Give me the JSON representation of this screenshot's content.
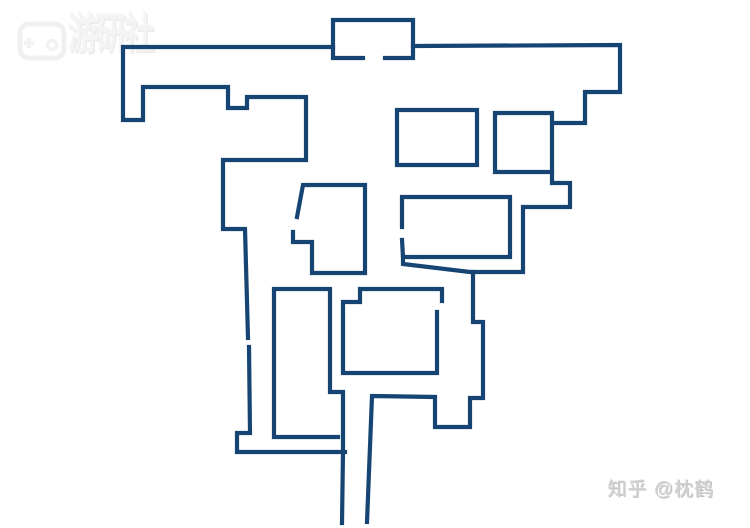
{
  "watermarks": {
    "logo": {
      "icon": "gamepad-icon",
      "brand_text": "游研社"
    },
    "credit": {
      "text": "知乎 @枕鹤"
    }
  },
  "map": {
    "background": "#ffffff",
    "stroke_color": "#164573",
    "stroke_width": 4.2,
    "width": 750,
    "height": 528,
    "polylines": [
      {
        "name": "top-center-room",
        "points": [
          [
            363,
            58
          ],
          [
            333,
            58
          ],
          [
            333,
            20
          ],
          [
            413,
            20
          ],
          [
            413,
            58
          ],
          [
            385,
            58
          ]
        ]
      },
      {
        "name": "top-left-wing-boundary",
        "points": [
          [
            333,
            47
          ],
          [
            123,
            47
          ],
          [
            123,
            120
          ],
          [
            143,
            120
          ],
          [
            143,
            87
          ],
          [
            228,
            87
          ],
          [
            228,
            108
          ],
          [
            247,
            108
          ],
          [
            247,
            97
          ],
          [
            306,
            97
          ],
          [
            306,
            160
          ],
          [
            223,
            160
          ],
          [
            223,
            229
          ],
          [
            245,
            229
          ],
          [
            248,
            338
          ]
        ]
      },
      {
        "name": "left-lower-boundary",
        "points": [
          [
            249,
            347
          ],
          [
            250,
            433
          ],
          [
            237,
            433
          ],
          [
            237,
            452
          ],
          [
            345,
            452
          ]
        ]
      },
      {
        "name": "tall-left-room-and-corridor-left-wall",
        "points": [
          [
            338,
            437
          ],
          [
            274,
            437
          ],
          [
            274,
            289
          ],
          [
            330,
            289
          ],
          [
            330,
            392
          ],
          [
            343,
            392
          ],
          [
            343,
            452
          ],
          [
            342,
            523
          ]
        ]
      },
      {
        "name": "top-right-boundary",
        "points": [
          [
            413,
            46
          ],
          [
            620,
            45
          ],
          [
            620,
            92
          ],
          [
            585,
            92
          ],
          [
            585,
            123
          ],
          [
            553,
            123
          ]
        ]
      },
      {
        "name": "upper-right-small-room",
        "points": [
          [
            495,
            113
          ],
          [
            552,
            113
          ],
          [
            552,
            172
          ],
          [
            495,
            172
          ],
          [
            495,
            113
          ]
        ]
      },
      {
        "name": "right-mid-boundary",
        "points": [
          [
            552,
            172
          ],
          [
            552,
            183
          ],
          [
            570,
            183
          ],
          [
            570,
            207
          ],
          [
            523,
            207
          ],
          [
            523,
            272
          ],
          [
            470,
            272
          ],
          [
            403,
            264
          ],
          [
            403,
            256
          ]
        ]
      },
      {
        "name": "right-lower-boundary-and-corridor-right-wall",
        "points": [
          [
            473,
            272
          ],
          [
            473,
            322
          ],
          [
            483,
            322
          ],
          [
            483,
            398
          ],
          [
            470,
            398
          ],
          [
            470,
            427
          ],
          [
            435,
            427
          ],
          [
            435,
            397
          ],
          [
            372,
            396
          ],
          [
            367,
            522
          ]
        ]
      },
      {
        "name": "mid-right-room",
        "points": [
          [
            402,
            240
          ],
          [
            403,
            257
          ],
          [
            510,
            257
          ],
          [
            510,
            197
          ],
          [
            402,
            197
          ],
          [
            402,
            227
          ]
        ]
      },
      {
        "name": "upper-mid-small-room",
        "points": [
          [
            397,
            110
          ],
          [
            477,
            110
          ],
          [
            477,
            165
          ],
          [
            397,
            165
          ],
          [
            397,
            110
          ]
        ]
      },
      {
        "name": "notched-left-room",
        "points": [
          [
            297,
            217
          ],
          [
            303,
            185
          ],
          [
            365,
            185
          ],
          [
            365,
            273
          ],
          [
            312,
            273
          ],
          [
            312,
            242
          ],
          [
            293,
            242
          ],
          [
            293,
            232
          ]
        ]
      },
      {
        "name": "center-room",
        "points": [
          [
            442,
            301
          ],
          [
            442,
            289
          ],
          [
            360,
            289
          ],
          [
            360,
            302
          ],
          [
            343,
            302
          ],
          [
            343,
            373
          ],
          [
            437,
            373
          ],
          [
            437,
            312
          ]
        ]
      }
    ]
  }
}
